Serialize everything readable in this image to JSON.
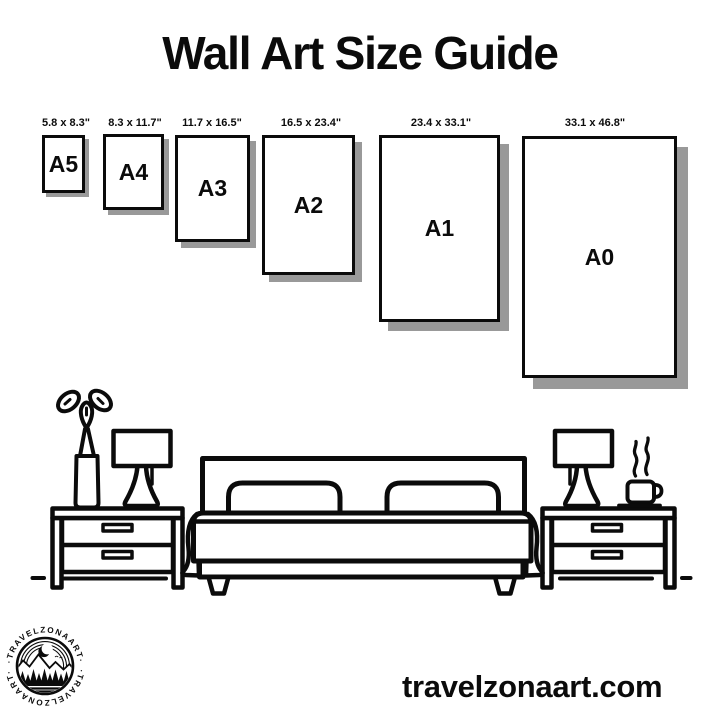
{
  "title": "Wall Art Size Guide",
  "frames": [
    {
      "name": "A5",
      "dimensions": "5.8 x 8.3\""
    },
    {
      "name": "A4",
      "dimensions": "8.3 x 11.7\""
    },
    {
      "name": "A3",
      "dimensions": "11.7 x 16.5\""
    },
    {
      "name": "A2",
      "dimensions": "16.5 x 23.4\""
    },
    {
      "name": "A1",
      "dimensions": "23.4 x 33.1\""
    },
    {
      "name": "A0",
      "dimensions": "33.1 x 46.8\""
    }
  ],
  "logo": {
    "arc_text_top": "·TRAVELZONAART·",
    "arc_text_bottom": "·TRAVELZONAART·"
  },
  "footer": {
    "website": "travelzonaart.com"
  },
  "colors": {
    "ink": "#0b0b0b",
    "shadow": "#999999",
    "background": "#ffffff"
  },
  "illustration": {
    "icons": [
      "potted-plant-icon",
      "table-lamp-icon",
      "nightstand-icon",
      "double-bed-icon",
      "pillow-icon",
      "coffee-cup-icon",
      "steam-icon",
      "floor-line-icon",
      "mountains-icon",
      "moon-icon",
      "trees-icon"
    ]
  }
}
